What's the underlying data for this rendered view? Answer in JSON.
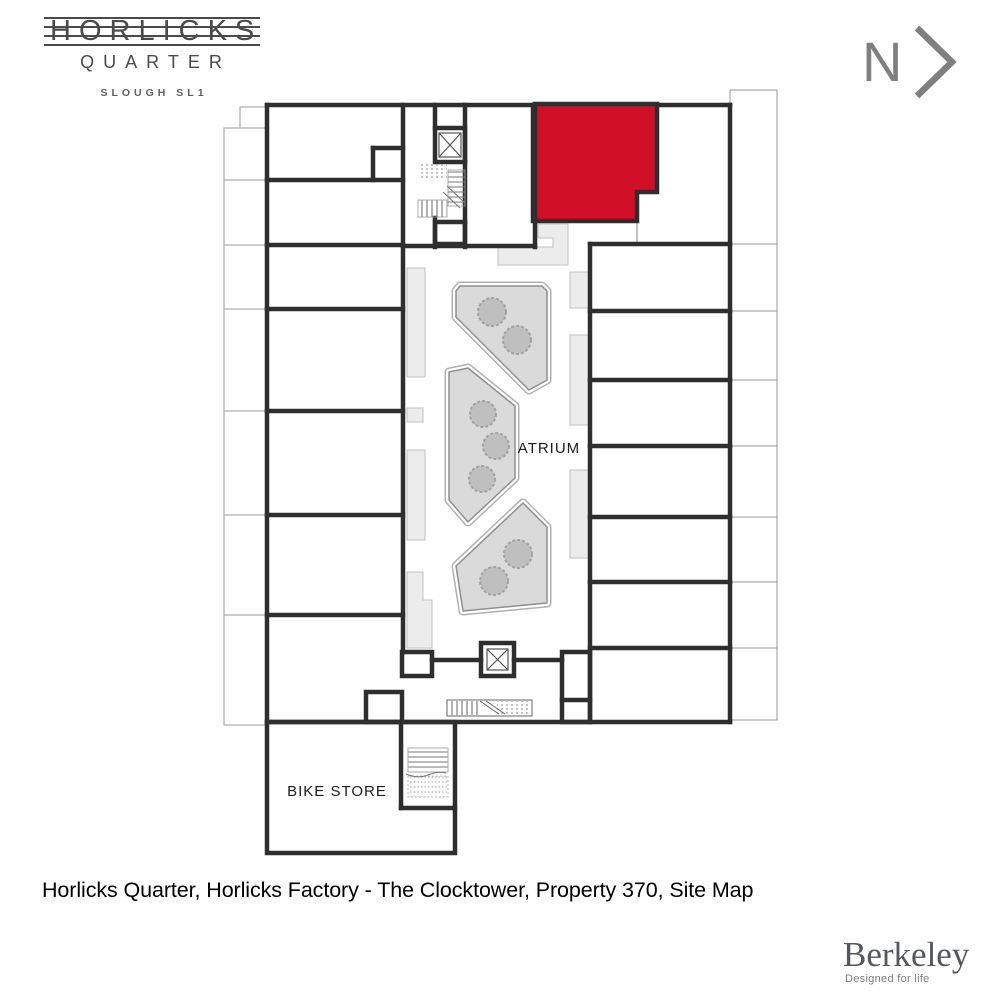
{
  "logo": {
    "name": "HORLICKS",
    "sub": "QUARTER",
    "location": "SLOUGH SL1"
  },
  "north": {
    "label": "N"
  },
  "plan": {
    "atrium_label": "ATRIUM",
    "bike_store_label": "BIKE STORE",
    "highlight_color": "#d10f27",
    "wall_color": "#2e2e2e",
    "highlighted_property": "370"
  },
  "caption": {
    "text": "Horlicks Quarter, Horlicks Factory - The Clocktower, Property 370, Site Map"
  },
  "brand": {
    "name": "Berkeley",
    "tagline": "Designed for life"
  }
}
